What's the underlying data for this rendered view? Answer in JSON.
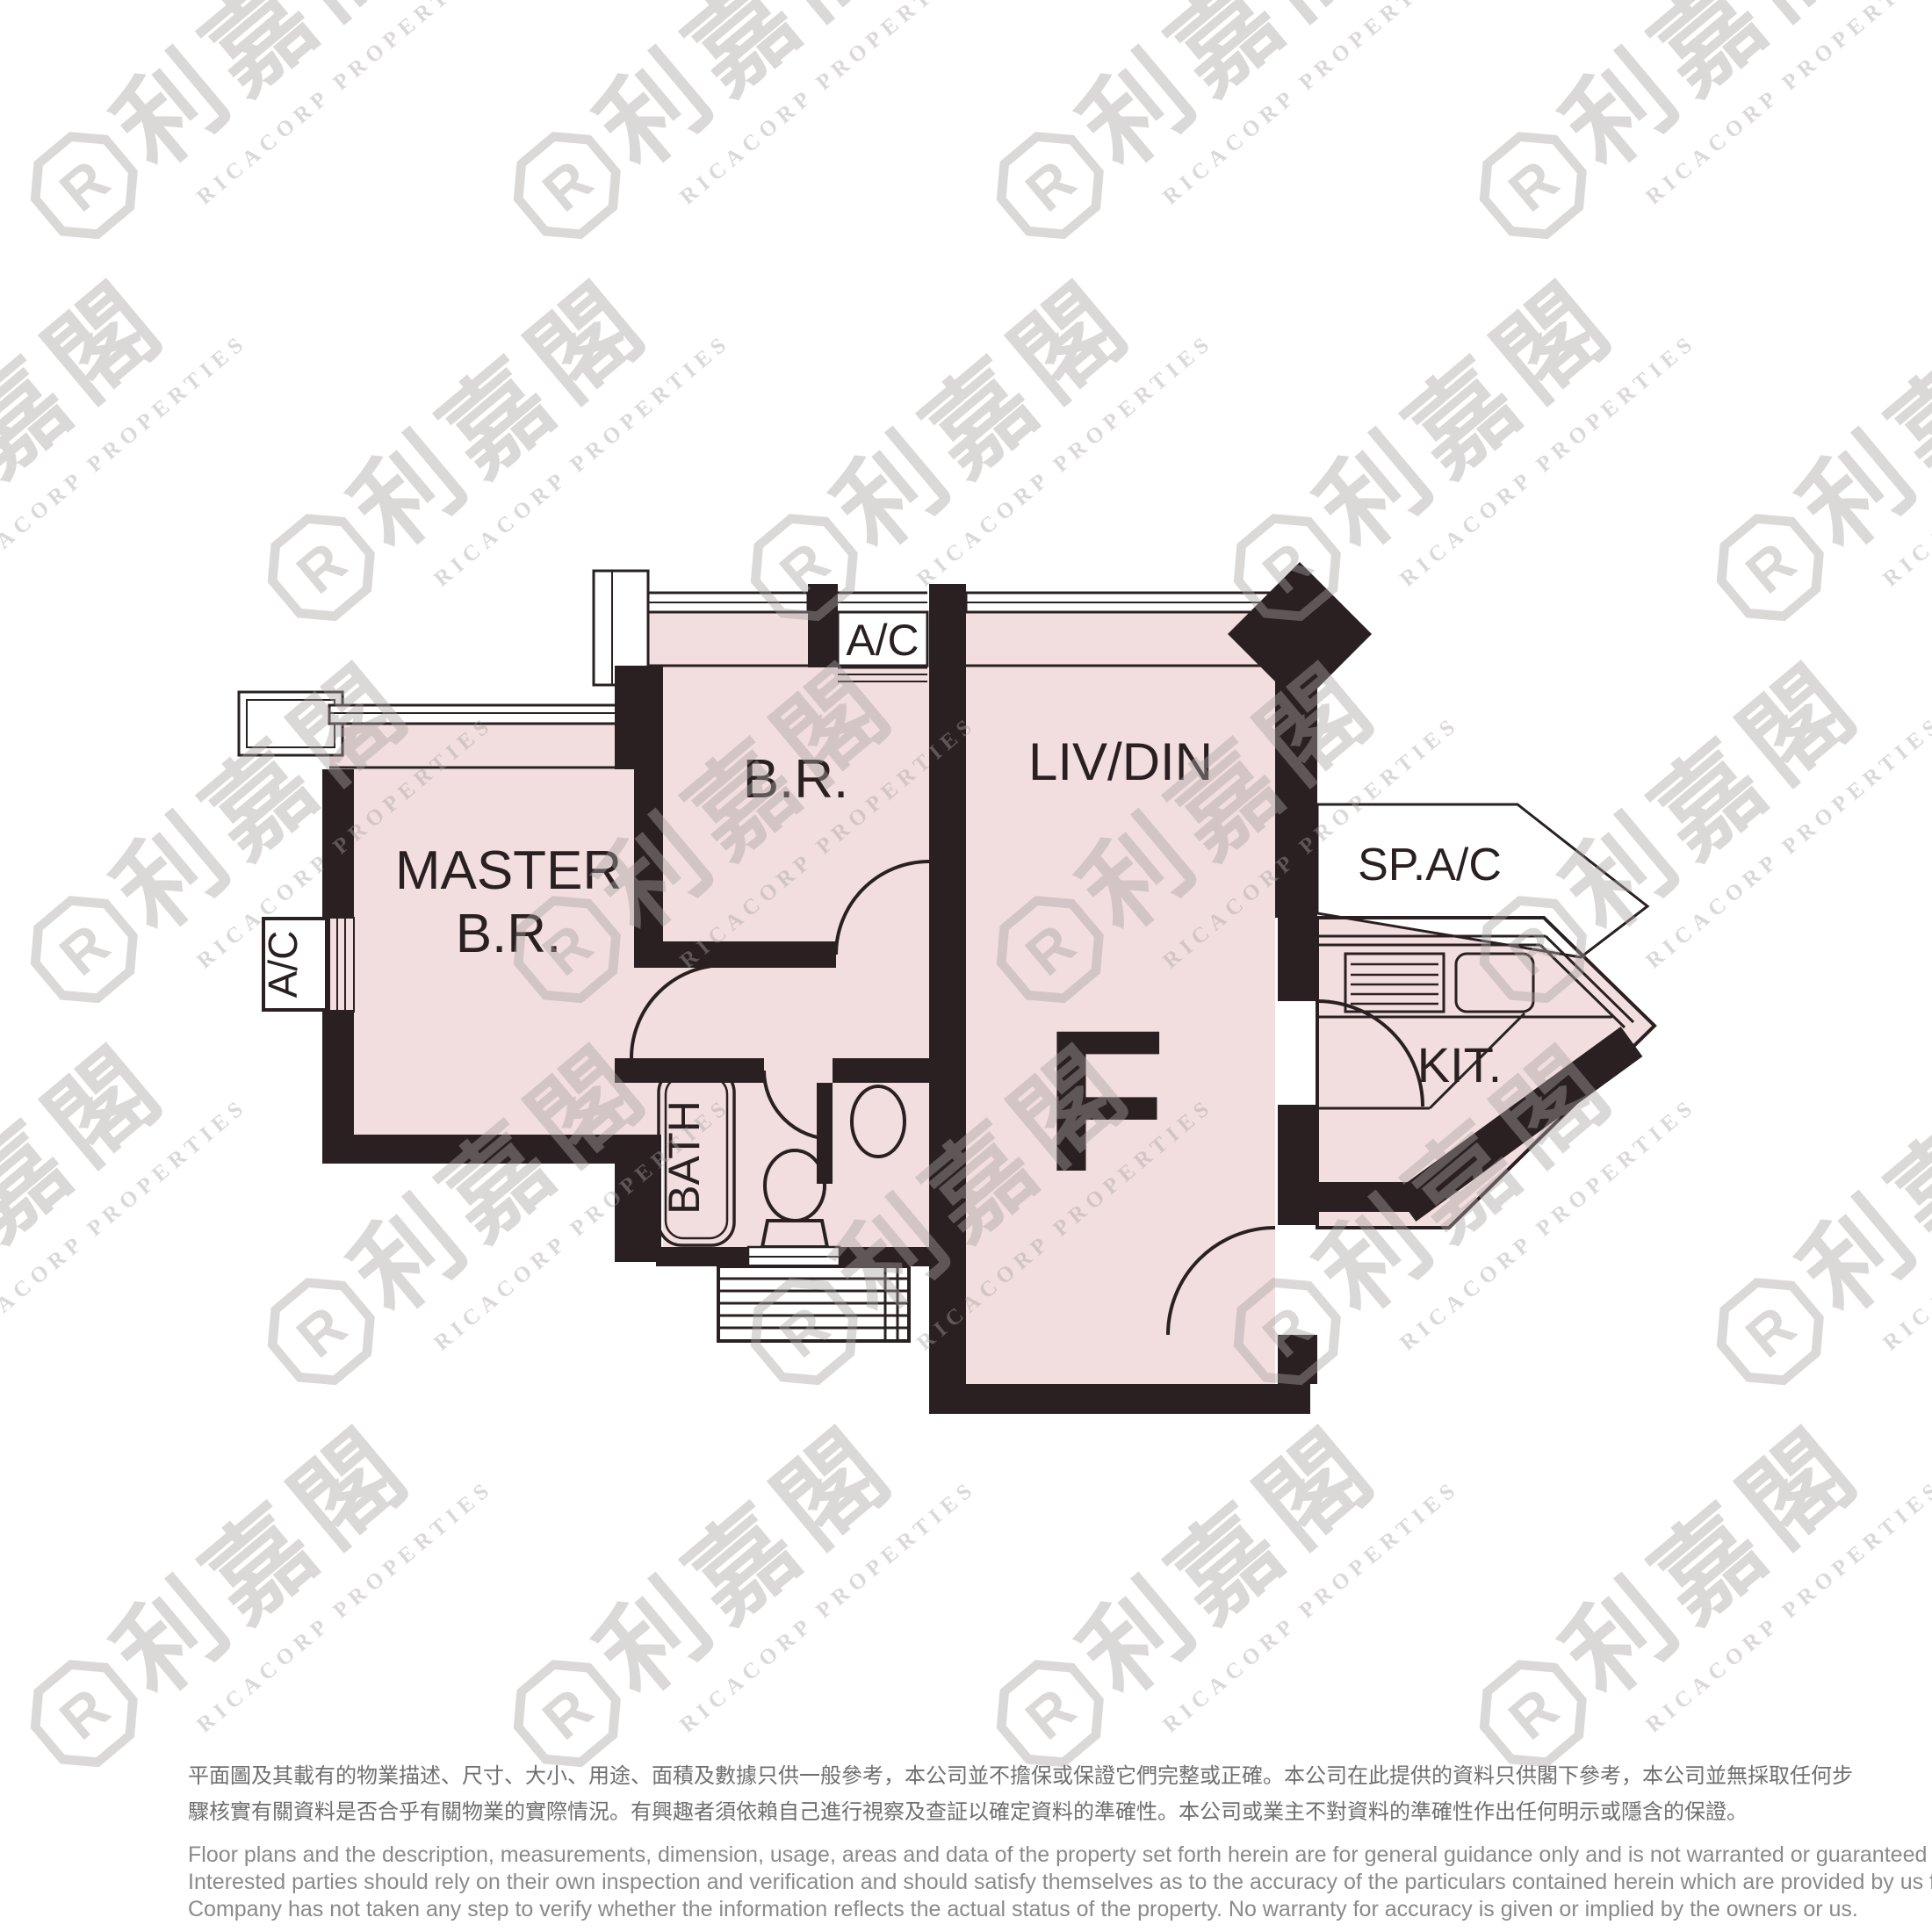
{
  "plan": {
    "unit_letter": "F",
    "labels": {
      "master_line1": "MASTER",
      "master_line2": "B.R.",
      "bedroom": "B.R.",
      "living_dining": "LIV/DIN",
      "kitchen": "KIT.",
      "bath": "BATH",
      "ac_top": "A/C",
      "ac_left": "A/C",
      "sp_ac": "SP.A/C"
    },
    "colors": {
      "wall": "#2A2022",
      "room_fill": "#F2DEDE",
      "background": "#FFFFFF"
    }
  },
  "watermark": {
    "chinese": "利嘉閣",
    "english": "RICACORP PROPERTIES",
    "logo_letter": "R",
    "color": "#E9E5E5"
  },
  "disclaimer": {
    "chinese_lines": [
      "平面圖及其載有的物業描述、尺寸、大小、用途、面積及數據只供一般參考，本公司並不擔保或保證它們完整或正確。本公司在此提供的資料只供閣下參考，本公司並無採取任何步",
      "驟核實有關資料是否合乎有關物業的實際情況。有興趣者須依賴自己進行視察及查証以確定資料的準確性。本公司或業主不對資料的準確性作出任何明示或隱含的保證。"
    ],
    "english_lines": [
      "Floor plans and the description, measurements, dimension, usage, areas and data of the property set forth herein are for general guidance only and is not warranted or guaranteed to be complete or correct.",
      "Interested parties should rely on their own inspection and verification and should satisfy themselves as to the accuracy of the particulars contained herein which are provided by us for information only.  Our",
      "Company has not taken any step to verify whether the information reflects the actual status of the property.  No warranty for accuracy is given or implied by the owners or us."
    ]
  }
}
